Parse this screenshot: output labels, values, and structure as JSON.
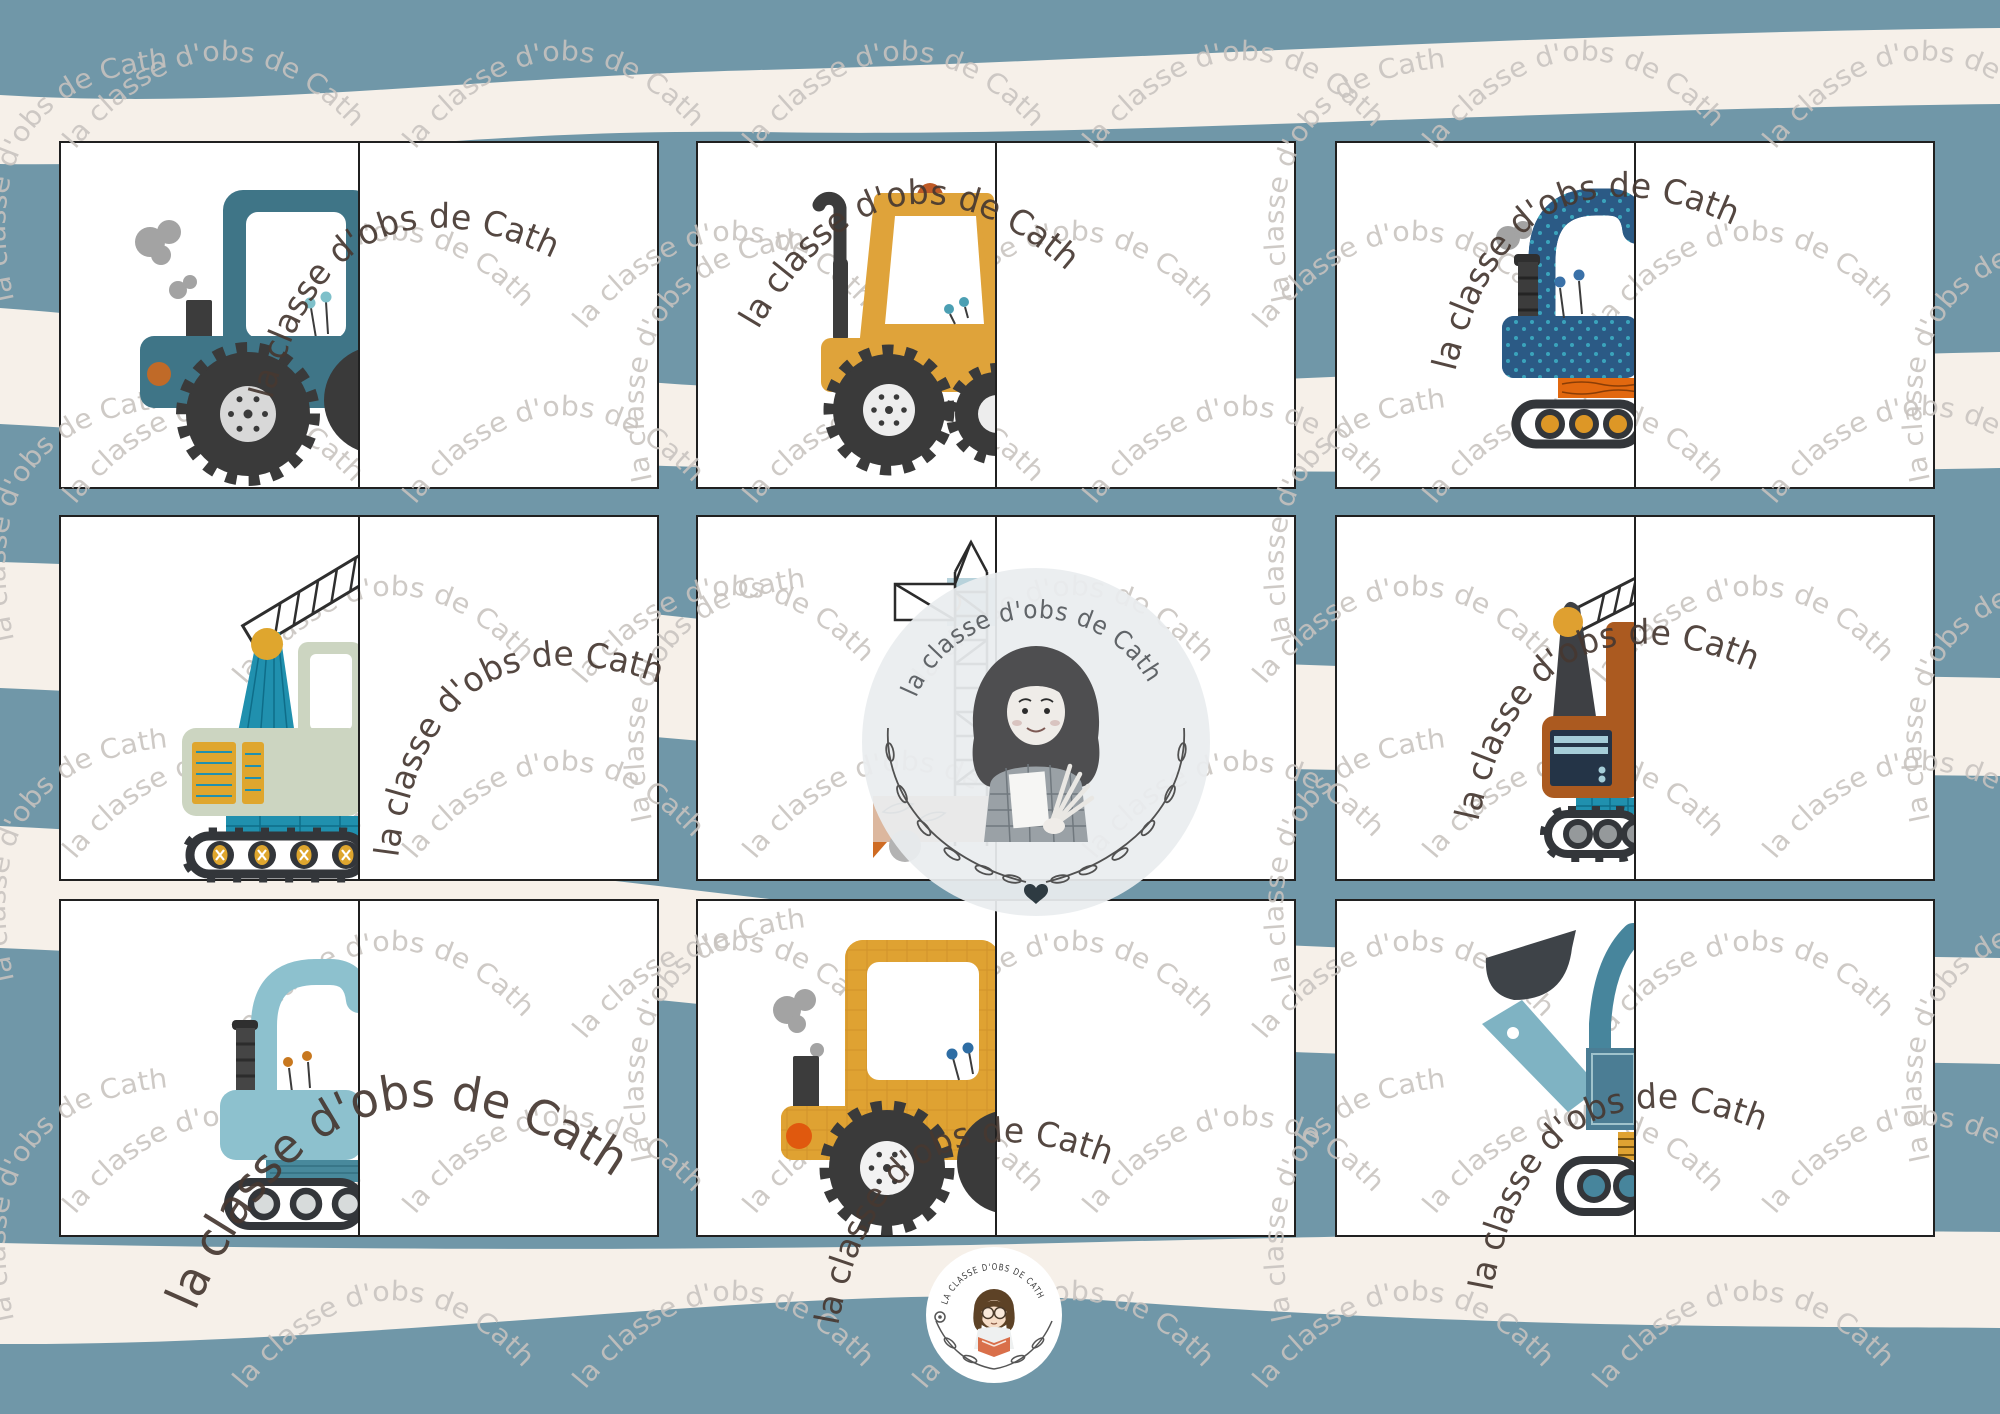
{
  "watermark": {
    "text": "la classe d'obs de Cath",
    "gray_color": "#c8c3bf",
    "dark_color": "#463831"
  },
  "brand": {
    "center_arc_text": "la classe d'obs de Cath",
    "badge_arc_text": "LA CLASSE D'OBS DE CATH"
  },
  "palette": {
    "background_blue": "#7097a8",
    "stripe_cream": "#f6f0e9",
    "card_white": "#ffffff",
    "card_border": "#202020",
    "teal_vehicle": "#3f7587",
    "yellow_vehicle": "#dfa33a",
    "navy_vehicle": "#2b5a85",
    "sage_vehicle": "#ccd5c1",
    "orange_vehicle": "#ab5a20",
    "light_blue_vehicle": "#8dc1ce",
    "slate_vehicle": "#4b7d94",
    "accent_orange": "#e2680f",
    "accent_teal": "#2090ae",
    "wheel_dark": "#3a3a3a"
  },
  "cards": [
    {
      "row": 1,
      "col": 1,
      "vehicle": "teal tractor (left half)"
    },
    {
      "row": 1,
      "col": 2,
      "vehicle": "yellow tractor with beacon (left half)"
    },
    {
      "row": 1,
      "col": 3,
      "vehicle": "navy dotted excavator on tracks (left half)"
    },
    {
      "row": 2,
      "col": 1,
      "vehicle": "sage crawler crane with lattice boom (left half)"
    },
    {
      "row": 2,
      "col": 2,
      "vehicle": "tower crane line art under brand logo circle"
    },
    {
      "row": 2,
      "col": 3,
      "vehicle": "orange crawler crane (left half)"
    },
    {
      "row": 3,
      "col": 1,
      "vehicle": "light blue excavator on tracks (left half)"
    },
    {
      "row": 3,
      "col": 2,
      "vehicle": "yellow plaid tractor (left half)"
    },
    {
      "row": 3,
      "col": 3,
      "vehicle": "blue front loader with bucket (left half)"
    }
  ]
}
